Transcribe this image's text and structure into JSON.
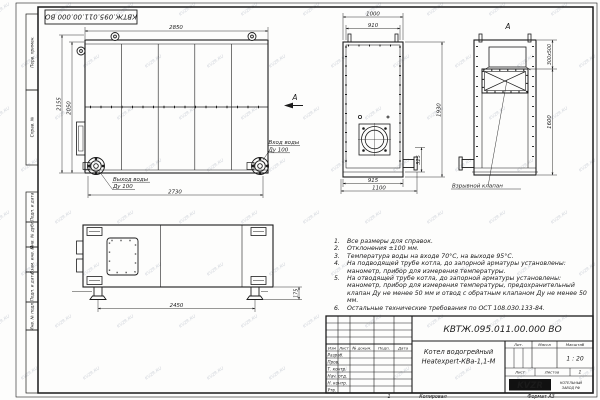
{
  "page": {
    "doc_number": "КВТЖ.095.011.00.000 ВО",
    "watermark": "KVZR.RU",
    "zone_label": "1",
    "kopiroval_label": "Копировал",
    "format_label": "Формат А3"
  },
  "stamps": {
    "items": [
      "Перв. примен.",
      "Справ. №",
      "Подп. и дата",
      "Инв. № дубл.",
      "Взам. инв. №",
      "Подп. и дата",
      "Инв. № подл."
    ]
  },
  "front": {
    "dim_top": "2850",
    "dim_height_outer": "2155",
    "dim_height_inner": "2050",
    "dim_bottom": "2730",
    "outlet_line1": "Выход воды",
    "outlet_line2": "Ду 100",
    "inlet_line1": "Вход воды",
    "inlet_line2": "Ду 100",
    "view_label": "А"
  },
  "side": {
    "dim_top_outer": "1000",
    "dim_top_inner": "910",
    "dim_height": "1930",
    "dim_pipe": "325",
    "dim_bottom_inner": "915",
    "dim_bottom_outer": "1100"
  },
  "view_a": {
    "label": "А",
    "dim_valve": "300x500",
    "dim_height": "1600",
    "callout": "Взрывной клапан"
  },
  "bottom": {
    "dim_span": "2450",
    "dim_feet": "175"
  },
  "notes": {
    "items": [
      {
        "n": "1.",
        "text": "Все размеры для справок."
      },
      {
        "n": "2.",
        "text": "Отклонения ±100 мм."
      },
      {
        "n": "3.",
        "text": "Температура воды на входе 70°С, на выходе 95°С."
      },
      {
        "n": "4.",
        "text": "На подводящей трубе котла, до запорной арматуры установлены: манометр, прибор для измерения температуры."
      },
      {
        "n": "5.",
        "text": "На отводящей трубе котла, до запорной арматуры установлены: манометр, прибор для измерения температуры, предохранительный клапан Ду не менее 50 мм и отвод с обратным клапаном Ду не менее 50 мм."
      },
      {
        "n": "6.",
        "text": "Остальные технические требования по ОСТ 108.030.133-84."
      }
    ]
  },
  "title_block": {
    "doc_number": "КВТЖ.095.011.00.000 ВО",
    "name_line1": "Котел водогрейный",
    "name_line2": "Heatexpert-КВа-1,1-М",
    "col_izm": "Изм",
    "col_list": "Лист",
    "col_doc": "№ докум.",
    "col_podp": "Подп.",
    "col_data": "Дата",
    "row_razrab": "Разраб.",
    "row_prov": "Пров.",
    "row_tkontr": "Т. контр.",
    "row_nachotd": "Нач. отд.",
    "row_nkontr": "Н. контр.",
    "row_utv": "Утв.",
    "lit_label": "Лит.",
    "mass_label": "Масса",
    "scale_label": "Масштаб",
    "scale_value": "1 : 20",
    "sheet_label": "Лист",
    "sheets_label": "Листов",
    "sheets_value": "1",
    "logo": "KVZR",
    "org_line1": "КОТЕЛЬНЫЙ",
    "org_line2": "ЗАВОД РФ"
  }
}
